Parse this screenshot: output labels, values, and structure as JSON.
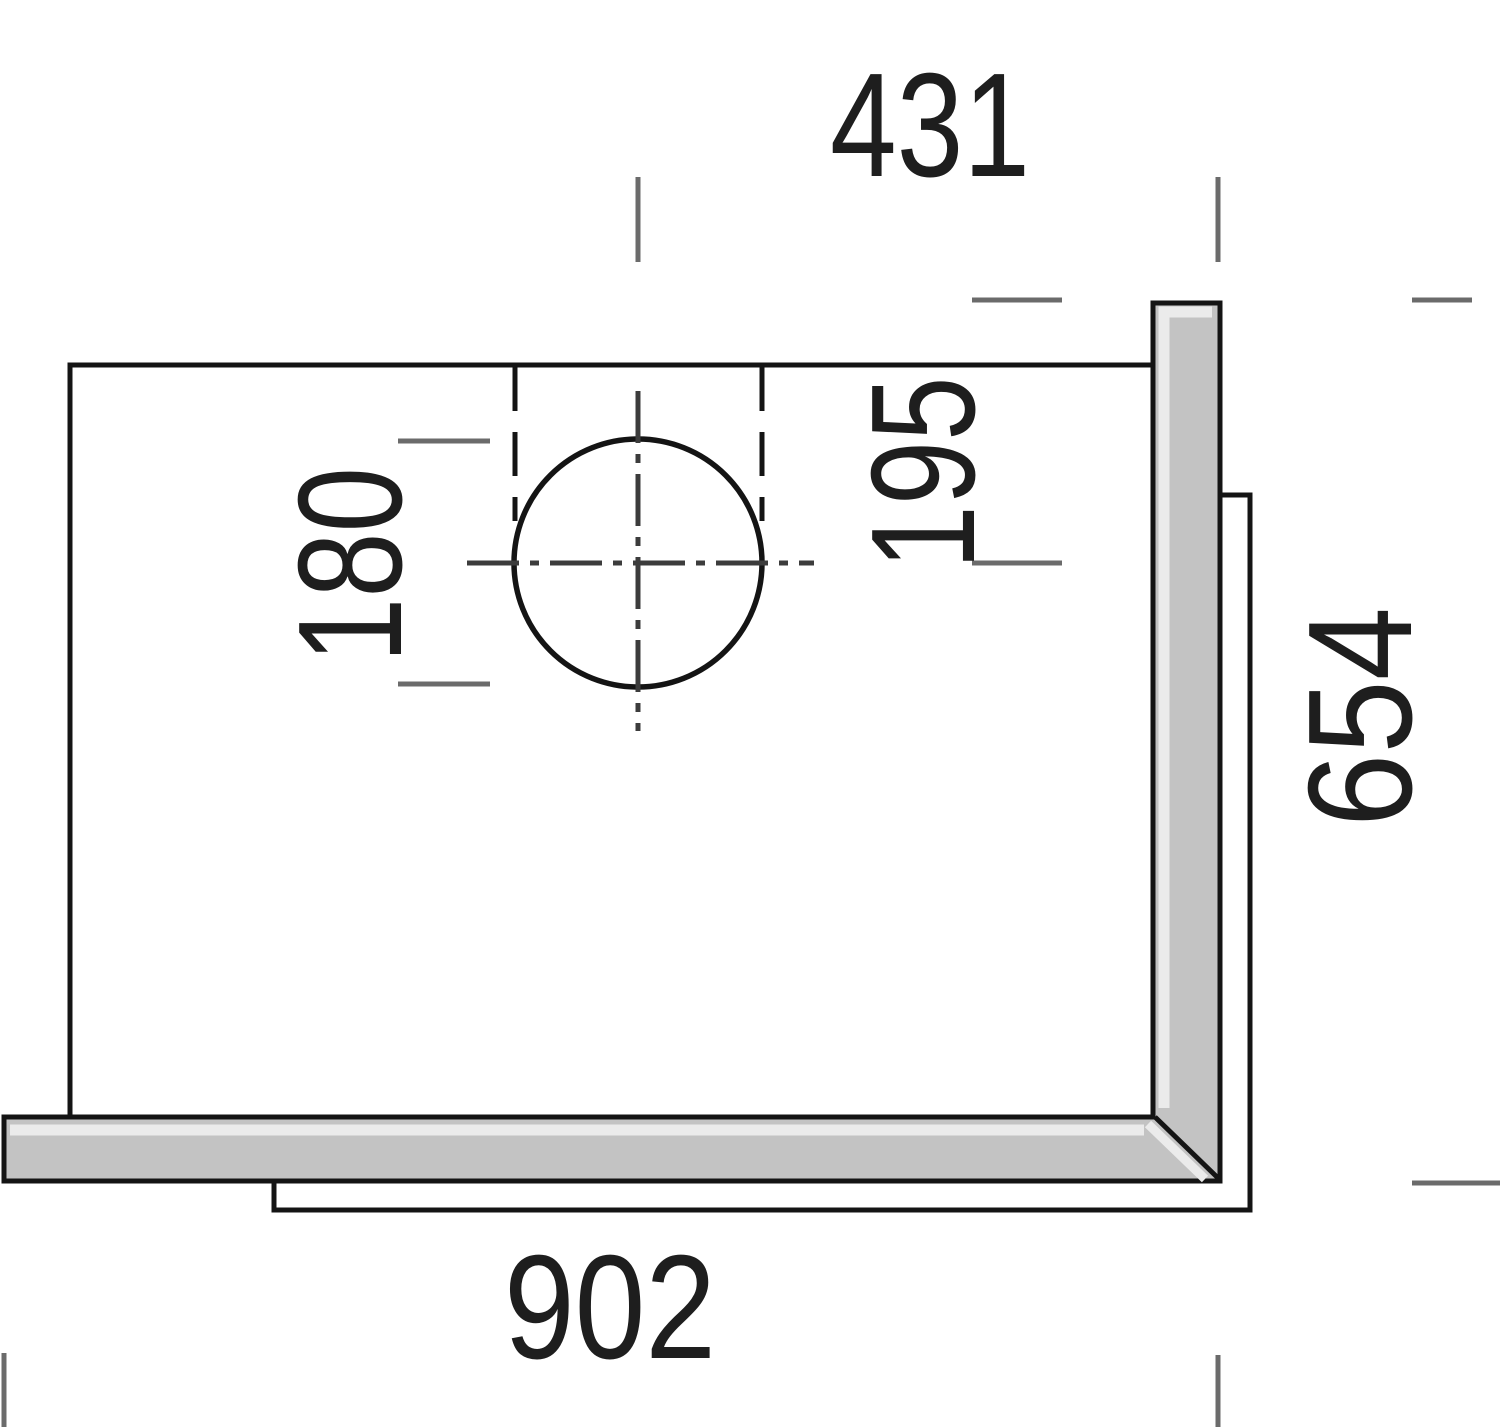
{
  "drawing": {
    "title": "Top-view installation dimension drawing",
    "dimensions": {
      "top": "431",
      "flue_offset": "195",
      "flue_diameter": "180",
      "right": "654",
      "bottom": "902"
    },
    "colors": {
      "panel_fill": "#c3c3c3",
      "panel_highlight": "#ebebeb",
      "line": "#141414",
      "tick": "#6b6b6b",
      "centerline": "#3c3c3c"
    }
  }
}
